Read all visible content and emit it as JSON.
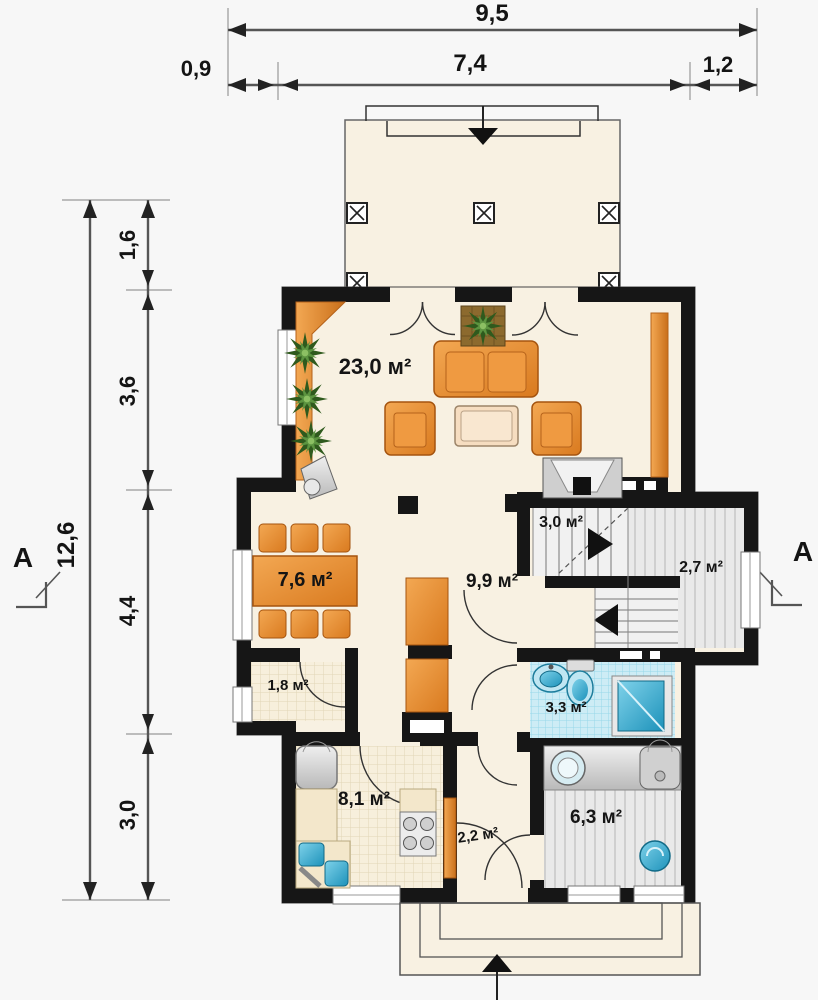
{
  "title": "House ground floor plan",
  "dimensions": {
    "top": {
      "overall": "9,5",
      "segments": [
        "0,9",
        "7,4",
        "1,2"
      ]
    },
    "left": {
      "overall": "12,6",
      "segments": [
        "1,6",
        "3,6",
        "4,4",
        "3,0"
      ]
    }
  },
  "section_markers": {
    "left": "A",
    "right": "A"
  },
  "rooms": {
    "living": {
      "label": "23,0 м²"
    },
    "stairs": {
      "label": "3,0 м²"
    },
    "landing": {
      "label": "2,7 м²"
    },
    "dining": {
      "label": "7,6 м²"
    },
    "hall": {
      "label": "9,9 м²"
    },
    "wc": {
      "label": "1,8 м²"
    },
    "bath": {
      "label": "3,3 м²"
    },
    "kitchen": {
      "label": "8,1 м²"
    },
    "vestibule": {
      "label": "2,2 м²"
    },
    "utility": {
      "label": "6,3 м²"
    }
  },
  "colors": {
    "floor_cream": "#f8f1e2",
    "wall_black": "#161616",
    "accent_orange": "#e5862c",
    "tile_blue": "#cdecf5",
    "fixture_blue": "#2fb4dc",
    "plant_green": "#3f7a2e",
    "floor_gray": "#e9e9e9",
    "dim_line": "#444444"
  }
}
